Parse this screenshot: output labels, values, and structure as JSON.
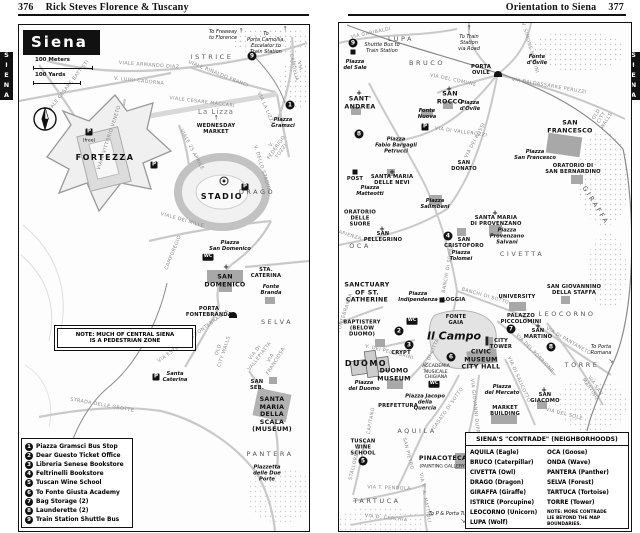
{
  "page": {
    "left_header": {
      "page_number": "376",
      "title": "Rick Steves Florence & Tuscany"
    },
    "right_header": {
      "title": "Orientation to Siena",
      "page_number": "377"
    },
    "side_tab_left": "SIENA",
    "side_tab_right": "SIENA"
  },
  "left_map": {
    "title": "Siena",
    "scale": {
      "meters": "100 Meters",
      "yards": "100 Yards"
    },
    "note": "NOTE: MUCH OF CENTRAL SIENA\nIS A PEDESTRIAN ZONE",
    "legend": {
      "items": [
        {
          "num": "1",
          "label": "Piazza Gramsci Bus Stop"
        },
        {
          "num": "2",
          "label": "Dear Guesto Ticket Office"
        },
        {
          "num": "3",
          "label": "Libreria Senese Bookstore"
        },
        {
          "num": "4",
          "label": "Feltrinelli Bookstore"
        },
        {
          "num": "5",
          "label": "Tuscan Wine School"
        },
        {
          "num": "6",
          "label": "To Fonte Giusta Academy"
        },
        {
          "num": "7",
          "label": "Bag Storage (2)"
        },
        {
          "num": "8",
          "label": "Launderette (2)"
        },
        {
          "num": "9",
          "label": "Train Station Shuttle Bus"
        }
      ]
    },
    "labels": [
      {
        "t": "To Freeway\nto Florence",
        "x": 204,
        "y": 10,
        "c": "tonote"
      },
      {
        "t": "↑",
        "x": 222,
        "y": 6,
        "c": "arrow"
      },
      {
        "t": "To\nPorta Camollia,\nEscalator to\nTrain Station",
        "x": 247,
        "y": 18,
        "c": "tonote"
      },
      {
        "t": "↑",
        "x": 266,
        "y": 4,
        "c": "arrow"
      },
      {
        "t": "9",
        "x": 233,
        "y": 31,
        "c": "marker"
      },
      {
        "t": "ISTRICE",
        "x": 193,
        "y": 33,
        "c": "area"
      },
      {
        "t": "VIA CAMOLLIA",
        "x": 277,
        "y": 42,
        "c": "street",
        "r": 78
      },
      {
        "t": "VIALE ARMANDO DIAZ",
        "x": 130,
        "y": 41,
        "c": "street",
        "r": 4
      },
      {
        "t": "V. LUIGI CADORNA",
        "x": 120,
        "y": 57,
        "c": "street",
        "r": 6
      },
      {
        "t": "VIALE CESARE BATTISTI",
        "x": 50,
        "y": 62,
        "c": "street",
        "r": -52
      },
      {
        "t": "VIALE RINALDO FRANCI",
        "x": 199,
        "y": 50,
        "c": "street",
        "r": 22
      },
      {
        "t": "La Lizza",
        "x": 197,
        "y": 87,
        "c": "gray"
      },
      {
        "t": "VIALE CESARE MACCARI",
        "x": 183,
        "y": 78,
        "c": "street",
        "r": 7
      },
      {
        "t": "VIA LA LIZZA",
        "x": 246,
        "y": 84,
        "c": "street",
        "r": 66
      },
      {
        "t": "1",
        "x": 271,
        "y": 80,
        "c": "marker"
      },
      {
        "t": "Piazza\nGramsci",
        "x": 264,
        "y": 98,
        "c": "piazza"
      },
      {
        "t": "↑",
        "x": 197,
        "y": 93,
        "c": "arrow"
      },
      {
        "t": "WEDNESDAY\nMARKET",
        "x": 197,
        "y": 104,
        "c": "tinyplace"
      },
      {
        "t": "VIALE VITTORIO VENETO",
        "x": 91,
        "y": 113,
        "c": "street",
        "r": -72
      },
      {
        "t": "VIALE 25 APRILE",
        "x": 172,
        "y": 125,
        "c": "street",
        "r": 62
      },
      {
        "t": "P",
        "x": 70,
        "y": 107,
        "c": "pbox"
      },
      {
        "t": "(free)",
        "x": 70,
        "y": 116,
        "c": "micro"
      },
      {
        "t": "FORTEZZA",
        "x": 86,
        "y": 133,
        "c": "bigplace"
      },
      {
        "t": "P",
        "x": 135,
        "y": 140,
        "c": "pbox"
      },
      {
        "t": "V. DELLO STADIO",
        "x": 242,
        "y": 143,
        "c": "street",
        "r": 73
      },
      {
        "t": "V. FEDERIGO TOZZI",
        "x": 258,
        "y": 123,
        "c": "street",
        "r": -55
      },
      {
        "t": "",
        "x": 205,
        "y": 156,
        "c": "ball"
      },
      {
        "t": "STADIO",
        "x": 203,
        "y": 172,
        "c": "bigplace"
      },
      {
        "t": "P",
        "x": 226,
        "y": 162,
        "c": "pbox"
      },
      {
        "t": "DRAGO",
        "x": 238,
        "y": 168,
        "c": "area"
      },
      {
        "t": "VIALE DEI MILLE",
        "x": 163,
        "y": 196,
        "c": "street",
        "r": 16
      },
      {
        "t": "CAMPOREGIO",
        "x": 155,
        "y": 228,
        "c": "street",
        "r": -68
      },
      {
        "t": "Piazza\nSan Domenico",
        "x": 211,
        "y": 221,
        "c": "piazza"
      },
      {
        "t": "+",
        "x": 207,
        "y": 242,
        "c": "cross"
      },
      {
        "t": "WC",
        "x": 189,
        "y": 232,
        "c": "wcbox"
      },
      {
        "t": "SAN\nDOMENICO",
        "x": 206,
        "y": 256,
        "c": "place"
      },
      {
        "t": "STA.\nCATERINA",
        "x": 247,
        "y": 248,
        "c": "tinyplace"
      },
      {
        "t": "Fonte\nBranda",
        "x": 252,
        "y": 265,
        "c": "piazza"
      },
      {
        "t": "PORTA\nFONTEBRANDA",
        "x": 190,
        "y": 287,
        "c": "tinyplace"
      },
      {
        "t": "",
        "x": 214,
        "y": 290,
        "c": "gate"
      },
      {
        "t": "VIA ESTERNA DI FONTEBRANDA",
        "x": 175,
        "y": 312,
        "c": "street",
        "r": -36
      },
      {
        "t": "OLD\nCITY WALLS",
        "x": 203,
        "y": 326,
        "c": "street",
        "r": -72
      },
      {
        "t": "SELVA",
        "x": 258,
        "y": 298,
        "c": "area"
      },
      {
        "t": "VIA DI VALLEPIATTA",
        "x": 239,
        "y": 330,
        "c": "street",
        "r": -52
      },
      {
        "t": "VIA FRANCIOSA",
        "x": 255,
        "y": 335,
        "c": "street",
        "r": -58
      },
      {
        "t": "P",
        "x": 137,
        "y": 352,
        "c": "pbox"
      },
      {
        "t": "Santa\nCaterina",
        "x": 156,
        "y": 352,
        "c": "piazza"
      },
      {
        "t": "STRADA DELLE GROTTE",
        "x": 83,
        "y": 381,
        "c": "street",
        "r": 10
      },
      {
        "t": "SAN\nSEB.",
        "x": 238,
        "y": 360,
        "c": "tinyplace"
      },
      {
        "t": "SANTA MARIA\nDELLA SCALA\n(MUSEUM)",
        "x": 253,
        "y": 390,
        "c": "place"
      },
      {
        "t": "PANTERA",
        "x": 251,
        "y": 430,
        "c": "area"
      },
      {
        "t": "Piazzetta\ndelle Due Porte",
        "x": 248,
        "y": 449,
        "c": "piazza"
      }
    ]
  },
  "right_map": {
    "contrade": {
      "title": "SIENA'S \"CONTRADE\" (NEIGHBORHOODS)",
      "left_column": [
        "AQUILA (Eagle)",
        "BRUCO (Caterpillar)",
        "CIVETTA (Owl)",
        "DRAGO (Dragon)",
        "GIRAFFA (Giraffe)",
        "ISTRICE (Porcupine)",
        "LEOCORNO (Unicorn)",
        "LUPA (Wolf)"
      ],
      "right_column": [
        "OCA (Goose)",
        "ONDA (Wave)",
        "PANTERA (Panther)",
        "SELVA (Forest)",
        "TARTUCA (Tortoise)",
        "TORRE (Tower)"
      ],
      "note": "NOTE: MORE CONTRADE\nLIE BEYOND THE MAP\nBOUNDARIES."
    },
    "labels": [
      {
        "t": "9",
        "x": 14,
        "y": 20,
        "c": "marker"
      },
      {
        "t": "",
        "x": 14,
        "y": 29,
        "c": "sq"
      },
      {
        "t": "Shuttle Bus to\nTrain Station",
        "x": 43,
        "y": 25,
        "c": "tonote"
      },
      {
        "t": "Piazza\ndel Sale",
        "x": 16,
        "y": 42,
        "c": "piazza"
      },
      {
        "t": "VIA GARIBALDI",
        "x": 32,
        "y": 11,
        "c": "street",
        "r": -12
      },
      {
        "t": "LUPA",
        "x": 62,
        "y": 17,
        "c": "area"
      },
      {
        "t": "To Train\nStation\nvia Road",
        "x": 130,
        "y": 20,
        "c": "tonote"
      },
      {
        "t": "↑",
        "x": 130,
        "y": 5,
        "c": "arrow"
      },
      {
        "t": "V. SIMONE MARTINI",
        "x": 190,
        "y": 25,
        "c": "street",
        "r": 74
      },
      {
        "t": "Fonte\nd'Ovile",
        "x": 198,
        "y": 37,
        "c": "piazza"
      },
      {
        "t": "BRUCO",
        "x": 88,
        "y": 41,
        "c": "area"
      },
      {
        "t": "PORTA\nOVILE",
        "x": 142,
        "y": 47,
        "c": "tinyplace"
      },
      {
        "t": "",
        "x": 159,
        "y": 51,
        "c": "gate"
      },
      {
        "t": "VIA BALDASSARRE PERUZZI",
        "x": 210,
        "y": 64,
        "c": "street",
        "r": 10
      },
      {
        "t": "OLD\nCITY WALLS",
        "x": 263,
        "y": 95,
        "c": "street",
        "r": -58
      },
      {
        "t": "VIA DEL COMUNE",
        "x": 114,
        "y": 58,
        "c": "street",
        "r": 12
      },
      {
        "t": "+",
        "x": 20,
        "y": 70,
        "c": "cross"
      },
      {
        "t": "SANT'\nANDREA",
        "x": 21,
        "y": 80,
        "c": "place"
      },
      {
        "t": "+",
        "x": 110,
        "y": 66,
        "c": "cross"
      },
      {
        "t": "SAN\nROCCO",
        "x": 111,
        "y": 75,
        "c": "place"
      },
      {
        "t": "Piazza\nd'Ovile",
        "x": 131,
        "y": 83,
        "c": "piazza"
      },
      {
        "t": "Fonte\nNuova",
        "x": 88,
        "y": 91,
        "c": "piazza"
      },
      {
        "t": "P",
        "x": 86,
        "y": 104,
        "c": "pbox"
      },
      {
        "t": "VIA DI VALLEROZZI",
        "x": 122,
        "y": 110,
        "c": "street",
        "r": 8
      },
      {
        "t": "VIA DEI ROSSI",
        "x": 137,
        "y": 118,
        "c": "street",
        "r": -62
      },
      {
        "t": "SAN\nFRANCESCO",
        "x": 231,
        "y": 104,
        "c": "place"
      },
      {
        "t": "Piazza\nSan Francesco",
        "x": 196,
        "y": 132,
        "c": "piazza"
      },
      {
        "t": "ORATORIO DI\nSAN BERNARDINO",
        "x": 234,
        "y": 146,
        "c": "tinyplace"
      },
      {
        "t": "GIRAFFA",
        "x": 256,
        "y": 183,
        "c": "area",
        "r": 58
      },
      {
        "t": "8",
        "x": 20,
        "y": 111,
        "c": "marker"
      },
      {
        "t": "Piazza\nFabio Bargagli\nPetrucci",
        "x": 57,
        "y": 123,
        "c": "piazza"
      },
      {
        "t": "+",
        "x": 53,
        "y": 149,
        "c": "cross"
      },
      {
        "t": "SANTA MARIA\nDELLE NEVI",
        "x": 53,
        "y": 157,
        "c": "tinyplace"
      },
      {
        "t": "",
        "x": 16,
        "y": 149,
        "c": "sq"
      },
      {
        "t": "POST",
        "x": 16,
        "y": 156,
        "c": "tinyplace"
      },
      {
        "t": "SAN\nDONATO",
        "x": 125,
        "y": 143,
        "c": "tinyplace"
      },
      {
        "t": "Piazza\nMatteotti",
        "x": 31,
        "y": 168,
        "c": "piazza"
      },
      {
        "t": "Piazza\nSalimbeni",
        "x": 96,
        "y": 181,
        "c": "piazza"
      },
      {
        "t": "ORATORIO\nDELLE\nSUORE",
        "x": 21,
        "y": 196,
        "c": "tinyplace"
      },
      {
        "t": "SAPIENZA",
        "x": 9,
        "y": 213,
        "c": "street",
        "r": 18
      },
      {
        "t": "+",
        "x": 43,
        "y": 206,
        "c": "cross"
      },
      {
        "t": "SAN\nPELLEGRINO",
        "x": 44,
        "y": 214,
        "c": "tinyplace"
      },
      {
        "t": "OCA",
        "x": 21,
        "y": 224,
        "c": "area"
      },
      {
        "t": "BANCHI DI SOPRA",
        "x": 110,
        "y": 246,
        "c": "street",
        "r": -80
      },
      {
        "t": "+",
        "x": 156,
        "y": 190,
        "c": "cross"
      },
      {
        "t": "SANTA MARIA\nDI PROVENZANO",
        "x": 157,
        "y": 198,
        "c": "tinyplace"
      },
      {
        "t": "Piazza\nProvenzano\nSalvani",
        "x": 168,
        "y": 214,
        "c": "piazza"
      },
      {
        "t": "4",
        "x": 109,
        "y": 213,
        "c": "marker"
      },
      {
        "t": "SAN\nCRISTOFORO",
        "x": 125,
        "y": 220,
        "c": "tinyplace"
      },
      {
        "t": "Piazza\nTolomei",
        "x": 122,
        "y": 233,
        "c": "piazza"
      },
      {
        "t": "CIVETTA",
        "x": 183,
        "y": 232,
        "c": "area"
      },
      {
        "t": "SAN GIOVANNINO\nDELLA STAFFA",
        "x": 235,
        "y": 267,
        "c": "tinyplace"
      },
      {
        "t": "LEOCORNO",
        "x": 228,
        "y": 292,
        "c": "area"
      },
      {
        "t": "SANCTUARY\nOF ST.\nCATHERINE",
        "x": 28,
        "y": 270,
        "c": "place"
      },
      {
        "t": "FONTEBRANDA",
        "x": 7,
        "y": 290,
        "c": "street",
        "r": -72
      },
      {
        "t": "Piazza\nIndipendenza",
        "x": 79,
        "y": 274,
        "c": "piazza"
      },
      {
        "t": "",
        "x": 103,
        "y": 277,
        "c": "sq"
      },
      {
        "t": "LOGGIA",
        "x": 115,
        "y": 277,
        "c": "tinyplace"
      },
      {
        "t": "BANCHI DI SOTTO",
        "x": 146,
        "y": 274,
        "c": "street",
        "r": 16
      },
      {
        "t": "UNIVERSITY",
        "x": 178,
        "y": 274,
        "c": "tinyplace"
      },
      {
        "t": "PALAZZO\nPICCOLOMINI",
        "x": 182,
        "y": 296,
        "c": "tinyplace"
      },
      {
        "t": "7",
        "x": 172,
        "y": 306,
        "c": "marker"
      },
      {
        "t": "WC",
        "x": 73,
        "y": 298,
        "c": "wcbox"
      },
      {
        "t": "BAPTISTERY\n(BELOW\nDUOMO)",
        "x": 23,
        "y": 306,
        "c": "tinyplace"
      },
      {
        "t": "2",
        "x": 60,
        "y": 308,
        "c": "marker"
      },
      {
        "t": "3",
        "x": 70,
        "y": 322,
        "c": "marker"
      },
      {
        "t": "V. DEI PELLEGRINI",
        "x": 50,
        "y": 330,
        "c": "street",
        "r": 14
      },
      {
        "t": "FONTE\nGAIA",
        "x": 117,
        "y": 297,
        "c": "tinyplace"
      },
      {
        "t": "Il Campo",
        "x": 115,
        "y": 313,
        "c": "campo"
      },
      {
        "t": "VIA DI CITTÀ",
        "x": 93,
        "y": 332,
        "c": "street",
        "r": -66
      },
      {
        "t": "CRYPT",
        "x": 62,
        "y": 330,
        "c": "tinyplace"
      },
      {
        "t": "DUOMO",
        "x": 27,
        "y": 341,
        "c": "bigplace"
      },
      {
        "t": "DUOMO\nMUSEUM",
        "x": 55,
        "y": 352,
        "c": "place"
      },
      {
        "t": "Piazza\ndel Duomo",
        "x": 25,
        "y": 363,
        "c": "piazza"
      },
      {
        "t": "",
        "x": 148,
        "y": 318,
        "c": "tower"
      },
      {
        "t": "CITY\nTOWER",
        "x": 162,
        "y": 321,
        "c": "tinyplace"
      },
      {
        "t": "CIVIC\nMUSEUM\nCITY HALL",
        "x": 142,
        "y": 337,
        "c": "place"
      },
      {
        "t": "6",
        "x": 112,
        "y": 334,
        "c": "marker"
      },
      {
        "t": "ACCADEMIA\nMUSICALE\nCHIGIANA",
        "x": 97,
        "y": 349,
        "c": "micro"
      },
      {
        "t": "VIA DI SALICOTTO",
        "x": 179,
        "y": 357,
        "c": "street",
        "r": 66
      },
      {
        "t": "VIA DEL PORRIONE",
        "x": 195,
        "y": 331,
        "c": "street",
        "r": 46
      },
      {
        "t": "+",
        "x": 199,
        "y": 303,
        "c": "cross"
      },
      {
        "t": "SAN\nMARTINO",
        "x": 199,
        "y": 311,
        "c": "tinyplace"
      },
      {
        "t": "8",
        "x": 212,
        "y": 324,
        "c": "marker"
      },
      {
        "t": "VIA DI PANTANETO",
        "x": 229,
        "y": 319,
        "c": "street",
        "r": 30
      },
      {
        "t": "To Porta\nRomana",
        "x": 262,
        "y": 327,
        "c": "tonote"
      },
      {
        "t": "↘",
        "x": 272,
        "y": 338,
        "c": "arrow"
      },
      {
        "t": "TORRE",
        "x": 243,
        "y": 343,
        "c": "area"
      },
      {
        "t": "VIA SAN MARTINO",
        "x": 253,
        "y": 365,
        "c": "street",
        "r": 55
      },
      {
        "t": "+",
        "x": 205,
        "y": 367,
        "c": "cross"
      },
      {
        "t": "SAN\nGIACOMO",
        "x": 206,
        "y": 375,
        "c": "tinyplace"
      },
      {
        "t": "VIA DEL SOLE",
        "x": 225,
        "y": 392,
        "c": "street",
        "r": 14
      },
      {
        "t": "Piazza\ndel Mercato",
        "x": 163,
        "y": 367,
        "c": "piazza"
      },
      {
        "t": "MARKET\nBUILDING",
        "x": 166,
        "y": 388,
        "c": "tinyplace"
      },
      {
        "t": "WC",
        "x": 95,
        "y": 361,
        "c": "wcbox"
      },
      {
        "t": "VIA GIOVANNI DUPRE",
        "x": 135,
        "y": 385,
        "c": "street",
        "r": 84
      },
      {
        "t": "CASATO DI SOTTO",
        "x": 110,
        "y": 386,
        "c": "street",
        "r": -55
      },
      {
        "t": "PREFETTURA",
        "x": 59,
        "y": 383,
        "c": "tinyplace"
      },
      {
        "t": "Piazza Jacopo\ndella\nQuercia",
        "x": 86,
        "y": 380,
        "c": "piazza"
      },
      {
        "t": "CAPITANO",
        "x": 33,
        "y": 398,
        "c": "street",
        "r": -80
      },
      {
        "t": "AQUILA",
        "x": 78,
        "y": 409,
        "c": "area"
      },
      {
        "t": "TUSCAN\nWINE\nSCHOOL",
        "x": 24,
        "y": 425,
        "c": "tinyplace"
      },
      {
        "t": "5",
        "x": 24,
        "y": 438,
        "c": "marker"
      },
      {
        "t": "PINACOTECA",
        "x": 104,
        "y": 436,
        "c": "place"
      },
      {
        "t": "(PAINTING GALLERY)",
        "x": 104,
        "y": 444,
        "c": "micro"
      },
      {
        "t": "SAN PIETRO",
        "x": 68,
        "y": 431,
        "c": "street",
        "r": 76
      },
      {
        "t": "STALLOREGGI",
        "x": 17,
        "y": 439,
        "c": "street",
        "r": -76
      },
      {
        "t": "VIA T. PENDOLA",
        "x": 50,
        "y": 466,
        "c": "street",
        "r": 2
      },
      {
        "t": "TARTUCA",
        "x": 38,
        "y": 479,
        "c": "area"
      },
      {
        "t": "VIA P. A. MATTIOLI",
        "x": 85,
        "y": 475,
        "c": "street",
        "r": 80
      },
      {
        "t": "VIA D. CERCHIA",
        "x": 47,
        "y": 496,
        "c": "street",
        "r": 6
      },
      {
        "t": "To P & Porta Tufi",
        "x": 110,
        "y": 491,
        "c": "tonote"
      },
      {
        "t": "↘",
        "x": 124,
        "y": 498,
        "c": "arrow"
      }
    ]
  }
}
